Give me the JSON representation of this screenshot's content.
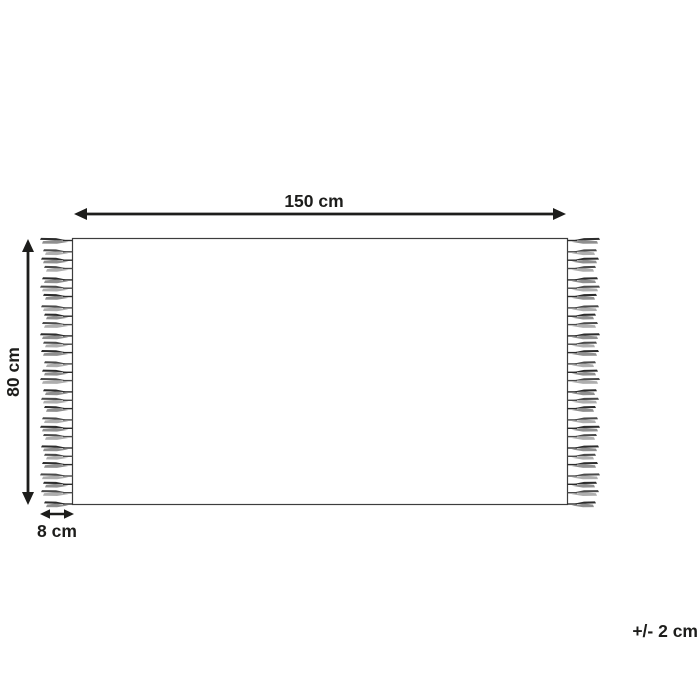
{
  "diagram": {
    "labels": {
      "width": "150 cm",
      "height": "80 cm",
      "fringe": "8 cm",
      "tolerance": "+/- 2 cm"
    },
    "tassels_per_side": 29,
    "colors": {
      "ink": "#1d1d1b",
      "outline": "#3d3d3d",
      "background": "#ffffff",
      "tassel_dark_a": "#2d2d2d",
      "tassel_light_a": "#8f8f8f",
      "tassel_dark_b": "#4b4b4b",
      "tassel_light_b": "#aeaeae"
    }
  }
}
